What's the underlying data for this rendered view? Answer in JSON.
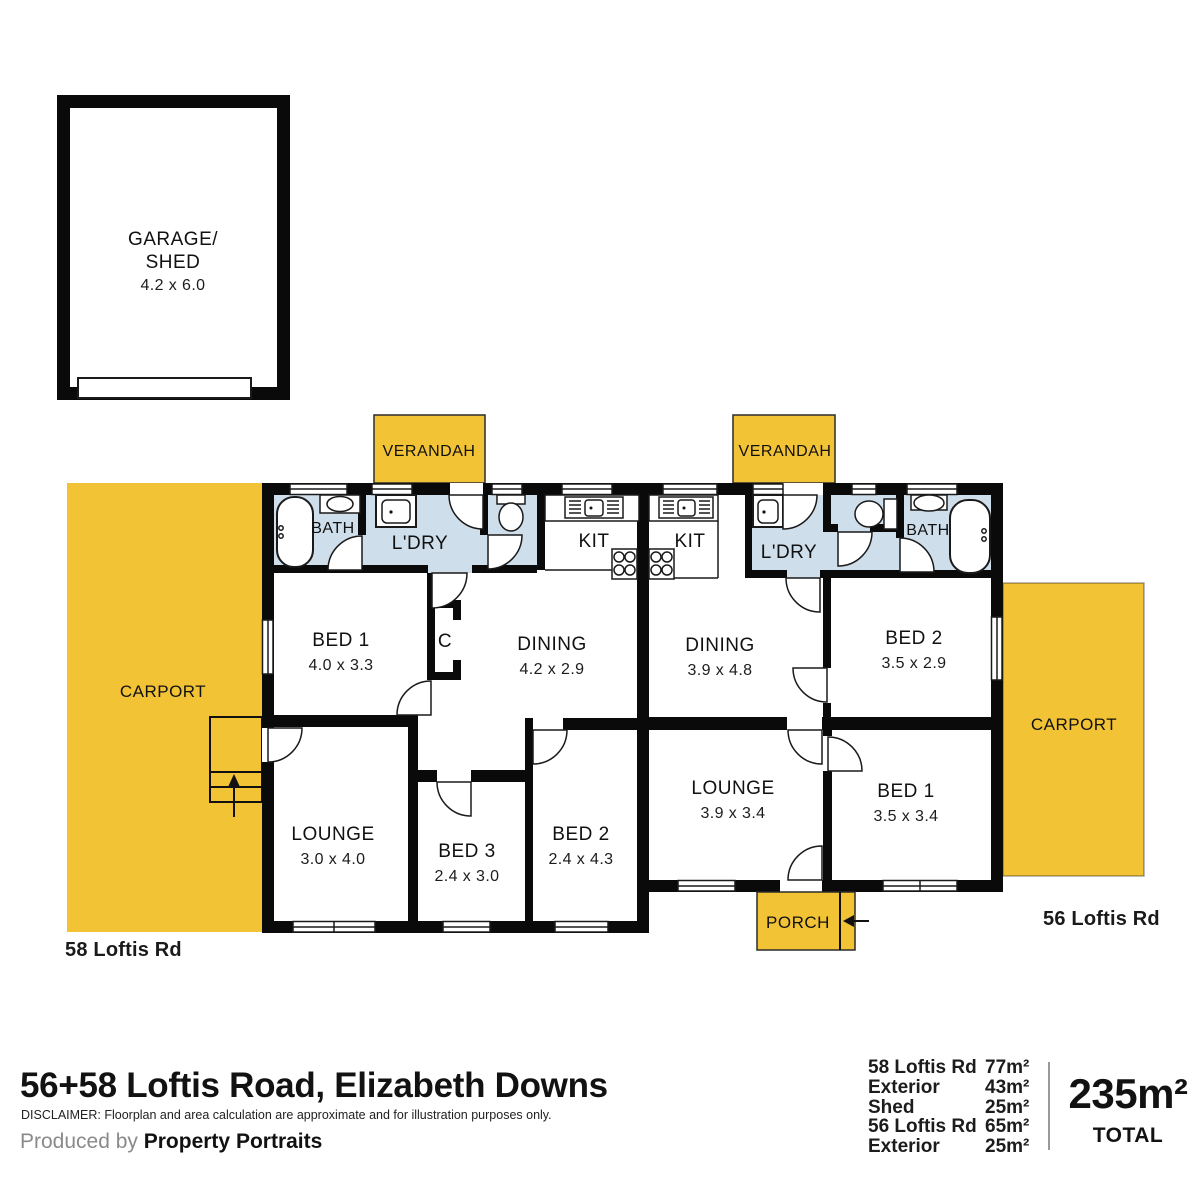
{
  "title": "56+58 Loftis Road, Elizabeth Downs",
  "disclaimer": "DISCLAIMER: Floorplan and area calculation are approximate and for illustration purposes only.",
  "credit": {
    "prefix": "Produced by ",
    "brand": "Property Portraits"
  },
  "summary": {
    "rows": [
      {
        "label": "58 Loftis Rd",
        "value": "77m²"
      },
      {
        "label": "Exterior",
        "value": "43m²"
      },
      {
        "label": "Shed",
        "value": "25m²"
      },
      {
        "label": "56 Loftis Rd",
        "value": "65m²"
      },
      {
        "label": "Exterior",
        "value": "25m²"
      }
    ],
    "total": "235m²",
    "total_label": "TOTAL"
  },
  "labels": {
    "verandah": "VERANDAH",
    "carport": "CARPORT",
    "porch": "PORCH",
    "garage_line1": "GARAGE/",
    "garage_line2": "SHED",
    "garage_dims": "4.2 x 6.0"
  },
  "unit58": {
    "street": "58 Loftis Rd",
    "bath": "BATH",
    "ldry": "L'DRY",
    "kit": "KIT",
    "cupboard": "C",
    "bed1": {
      "label": "BED 1",
      "dims": "4.0 x 3.3"
    },
    "dining": {
      "label": "DINING",
      "dims": "4.2 x 2.9"
    },
    "lounge": {
      "label": "LOUNGE",
      "dims": "3.0 x 4.0"
    },
    "bed3": {
      "label": "BED 3",
      "dims": "2.4 x 3.0"
    },
    "bed2": {
      "label": "BED 2",
      "dims": "2.4 x 4.3"
    }
  },
  "unit56": {
    "street": "56 Loftis Rd",
    "kit": "KIT",
    "ldry": "L'DRY",
    "bath": "BATH",
    "dining": {
      "label": "DINING",
      "dims": "3.9 x 4.8"
    },
    "bed2": {
      "label": "BED 2",
      "dims": "3.5 x 2.9"
    },
    "lounge": {
      "label": "LOUNGE",
      "dims": "3.9 x 3.4"
    },
    "bed1": {
      "label": "BED 1",
      "dims": "3.5 x 3.4"
    }
  },
  "colors": {
    "exterior_yellow": "#F2C335",
    "wet_area_blue": "#CFDEEB",
    "wall_black": "#0A0A0A",
    "background": "#FFFFFF"
  }
}
